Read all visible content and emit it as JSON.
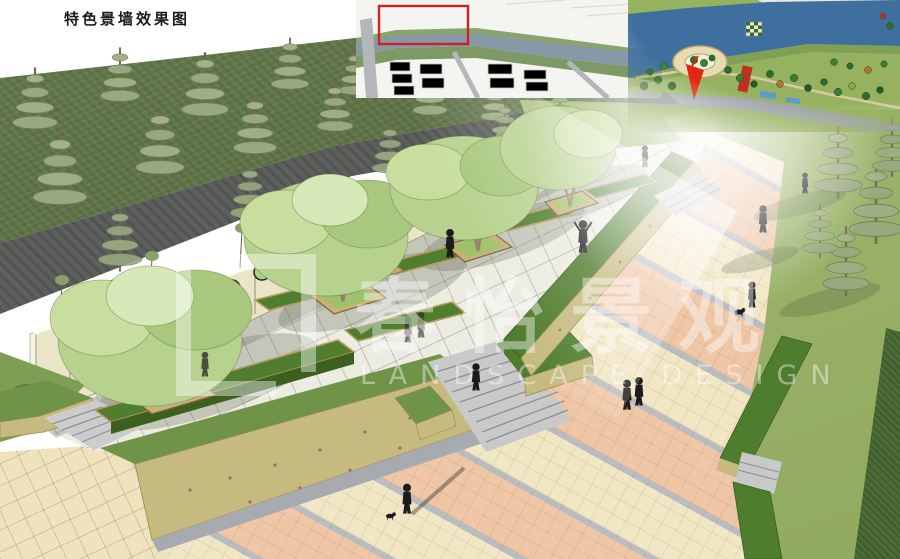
{
  "board": {
    "title": "特色景墙效果图"
  },
  "watermark": {
    "cn": "春怡景观",
    "en": "LANDSCAPE DESIGN"
  },
  "scene": {
    "wall_circles": [
      "#2bb9c9",
      "#84c45e",
      "#e0a23c",
      "#2a9fae",
      "#a8d08a",
      "#e0a23c",
      "#a8d08a",
      "#2bb9c9",
      "#e3b43c",
      "#84c45e",
      "#e0a23c",
      "#2a9fae",
      "#e3b43c"
    ]
  },
  "colors": {
    "highlight": "#cc2222",
    "arrow": "#e02712",
    "wall": "#eae6c8",
    "paving_pink": "#efc7a7",
    "paving_cream": "#f2e7c5",
    "plaza": "#edece3",
    "hedge": "#4f7d2e",
    "lawn": "#a9bf78",
    "stone": "#c6ba7f",
    "river": "#3f6f9e"
  }
}
